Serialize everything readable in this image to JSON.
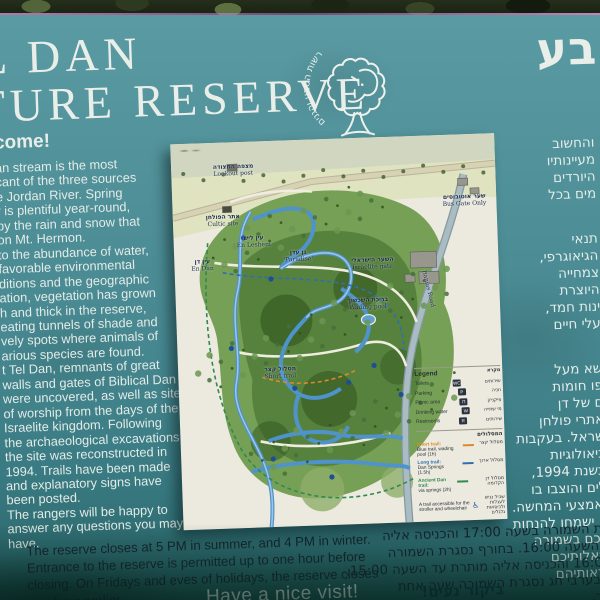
{
  "sign": {
    "title": {
      "en_line1": "L DAN",
      "en_line2": "TURE RESERVE",
      "he_fragment": "בע"
    },
    "logo": {
      "name": "israel-nature-and-parks-authority-logo",
      "arc_text": "רשות הטבע והגנים"
    },
    "welcome": {
      "heading": "come!",
      "lines": [
        "an stream is the most",
        "cant of the three sources",
        "e Jordan River. Spring",
        "r is plentiful year-round,",
        "by the rain and snow that",
        "on Mt. Hermon.",
        "to the abundance of water,",
        "favorable environmental",
        "ditions and the geographic",
        "ation, vegetation has grown",
        "h and thick in the reserve,",
        "eating tunnels of shade and",
        "vely spots where animals of",
        "arious species are found.",
        "t Tel Dan, remnants of great",
        "walls and gates of Biblical Dan",
        "were uncovered, as well as sites",
        "of worship from the days of the",
        "Israelite kingdom. Following",
        "the archaeological excavations,",
        "the site was reconstructed in",
        "1994. Trails have been made",
        "and explanatory signs have",
        "been posted.",
        "The rangers will be happy to",
        "answer any questions you may",
        "have."
      ]
    },
    "hours_en": {
      "lines": [
        "The reserve closes at 5 PM in summer, and 4 PM in winter.",
        "Entrance to the reserve is permitted up to one hour before",
        "closing. On Fridays and eves of holidays, the reserve closes",
        "one hour earlier."
      ]
    },
    "farewell_en": "Have a nice visit!",
    "hebrew_column": {
      "lines": [
        "והחשוב",
        "מעיינותיו",
        "היורדים",
        "מים בכל",
        "",
        "תנאי",
        "הגיאוגרפי,",
        "צמחייה",
        "היוצרת",
        "ינות חמד,",
        "עלי חיים",
        "",
        "שא מעל",
        "פו חומות",
        "ם של דן",
        "אתרי פולחן",
        "שראל. בעקבות",
        "כיאולוגיות",
        "בשנת 1994,",
        "לים והוצבו בו",
        "ואמצעי המחשה.",
        "ה ישמחו להנחות",
        "רכם בשמורה",
        "שאלותיכם",
        "וראותיהם"
      ]
    },
    "hours_he": {
      "lines": [
        "רת השמורה בשעה 17:00 והכניסה אליה",
        "ד השעה 16:00. בחורף נסגרת השמורה",
        "16:00 והכניסה אליה מותרת עד השעה 15:00.",
        "י ובערבי חג נסגרת השמורה שעה אחת",
        "תר."
      ]
    },
    "farewell_he": "ביקור נעים!"
  },
  "map": {
    "labels": [
      {
        "id": "lookout-post",
        "he": "מצפה המצודה",
        "en": "Lookout post",
        "x": 62,
        "y": 22,
        "rotate": 0
      },
      {
        "id": "cultic-site",
        "he": "אתר הפולחן",
        "en": "Cultic site",
        "x": 50,
        "y": 72,
        "rotate": 0
      },
      {
        "id": "bus-gate",
        "he": "שער אוטובוסים",
        "en": "Bus Gate Only",
        "x": 292,
        "y": 60,
        "rotate": 0
      },
      {
        "id": "en-leshem",
        "he": "עין ליש",
        "en": "En Leshem",
        "x": 80,
        "y": 94,
        "rotate": 0
      },
      {
        "id": "en-dan",
        "he": "עין דן",
        "en": "En Dan",
        "x": 28,
        "y": 116,
        "rotate": 0
      },
      {
        "id": "paradise",
        "he": "גן עדן",
        "en": "'Paradise'",
        "x": 124,
        "y": 110,
        "rotate": 0
      },
      {
        "id": "israelite-gate",
        "he": "השער הישראלי",
        "en": "Israelite gate",
        "x": 198,
        "y": 120,
        "rotate": 0
      },
      {
        "id": "wading-pool",
        "he": "בריכת השכשוך",
        "en": "Wading pool",
        "x": 192,
        "y": 160,
        "rotate": 0
      },
      {
        "id": "short-trail",
        "he": "מסלול קצר",
        "en": "Short trail",
        "x": 102,
        "y": 226,
        "rotate": 0
      },
      {
        "id": "banias-road",
        "he": "",
        "en": "Banias Road",
        "x": 252,
        "y": 150,
        "rotate": 78
      }
    ],
    "legend": {
      "title_en": "Legend",
      "title_he": "מקרא",
      "facilities": [
        {
          "icon": "toilets-icon",
          "glyph": "WC",
          "en": "Toilets",
          "he": "שירותים"
        },
        {
          "icon": "parking-icon",
          "glyph": "P",
          "en": "Parking",
          "he": "חניה"
        },
        {
          "icon": "picnic-icon",
          "glyph": "Π",
          "en": "Picnic area",
          "he": "פיקניק"
        },
        {
          "icon": "drinking-water-icon",
          "glyph": "W",
          "en": "Drinking water",
          "he": "מי שתייה"
        },
        {
          "icon": "restrooms-icon",
          "glyph": "R",
          "en": "Restrooms",
          "he": "שירותים"
        }
      ],
      "trails_title_he": "המסלולים",
      "trails": [
        {
          "name_en": "Short trail:",
          "desc_en": "Blue trail, wading pool (1h)",
          "he": "מסלול קצר",
          "color": "#d98a2b"
        },
        {
          "name_en": "Long trail:",
          "desc_en": "Dan Springs (1.5h)",
          "he": "מסלול ארוך",
          "color": "#2f6fb0"
        },
        {
          "name_en": "Ancient Dan trail:",
          "desc_en": "via springs (2h)",
          "he": "מסלול דן הקדומה",
          "color": "#2f8a4f"
        }
      ],
      "accessible_en": "A trail accessible for the stroller and wheelchair",
      "accessible_he": "שביל נגיש לעגלות ולכיסאות גלגלים",
      "trail_start_en": "Beginning of trail",
      "trail_end_en": "End of trail",
      "start_icon": "wheelchair-icon",
      "end_icon": "trail-end-icon"
    }
  },
  "colors": {
    "sign_teal": "#478891",
    "text_white": "#e9eee9",
    "text_dark": "#16242c",
    "map_paper": "#ece9de",
    "stream_blue": "#4f93cc",
    "forest_green": "#527d3b"
  }
}
